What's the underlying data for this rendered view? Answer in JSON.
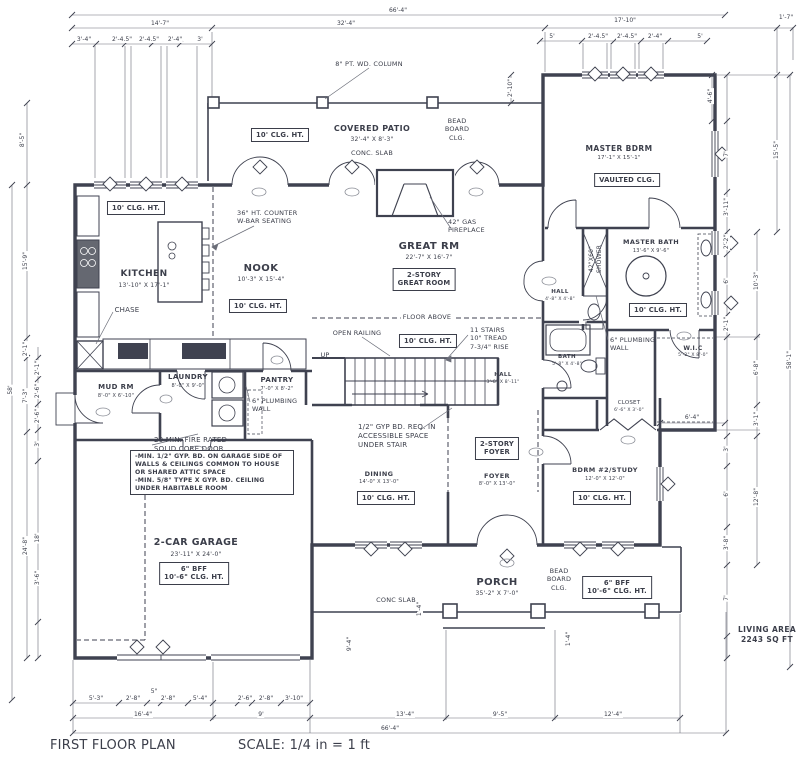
{
  "labels": [
    {
      "id": "title",
      "lines": [
        "FIRST FLOOR PLAN"
      ],
      "x": 50,
      "y": 738,
      "size": 13,
      "align": "l"
    },
    {
      "id": "scale-note",
      "lines": [
        "SCALE: 1/4 in = 1 ft"
      ],
      "x": 238,
      "y": 738,
      "size": 13,
      "align": "l"
    },
    {
      "id": "living-area",
      "lines": [
        "LIVING AREA",
        "2243 SQ FT"
      ],
      "x": 767,
      "y": 625,
      "size": 7.5,
      "bold": true
    },
    {
      "id": "covered-patio",
      "lines": [
        "COVERED PATIO"
      ],
      "x": 372,
      "y": 124,
      "size": 8,
      "bold": true
    },
    {
      "id": "covered-patio-dims",
      "lines": [
        "32'-4\" X 8'-3\""
      ],
      "x": 372,
      "y": 136,
      "size": 6
    },
    {
      "id": "patio-conc-slab",
      "lines": [
        "CONC. SLAB"
      ],
      "x": 372,
      "y": 149,
      "size": 6.5
    },
    {
      "id": "patio-clg-box",
      "lines": [
        "10' CLG. HT."
      ],
      "x": 280,
      "y": 128,
      "box": true
    },
    {
      "id": "column-note",
      "lines": [
        "8\" PT. WD. COLUMN"
      ],
      "x": 369,
      "y": 60,
      "size": 6.5
    },
    {
      "id": "bead-board-clg-top",
      "lines": [
        "BEAD",
        "BOARD",
        "CLG."
      ],
      "x": 457,
      "y": 117,
      "size": 6.5
    },
    {
      "id": "master-bdrm",
      "lines": [
        "MASTER BDRM"
      ],
      "x": 619,
      "y": 144,
      "size": 7.5,
      "bold": true
    },
    {
      "id": "master-bdrm-dims",
      "lines": [
        "17'-1\" X 15'-1\""
      ],
      "x": 619,
      "y": 155,
      "size": 5.5
    },
    {
      "id": "vaulted-clg-box",
      "lines": [
        "VAULTED CLG."
      ],
      "x": 627,
      "y": 173,
      "box": true
    },
    {
      "id": "kitchen",
      "lines": [
        "KITCHEN"
      ],
      "x": 144,
      "y": 269,
      "size": 9,
      "bold": true
    },
    {
      "id": "kitchen-dims",
      "lines": [
        "13'-10\" X 17'-1\""
      ],
      "x": 144,
      "y": 282,
      "size": 6
    },
    {
      "id": "kitchen-clg-box",
      "lines": [
        "10' CLG. HT."
      ],
      "x": 136,
      "y": 201,
      "box": true
    },
    {
      "id": "counter-note",
      "lines": [
        "36\" HT. COUNTER",
        "W-BAR SEATING"
      ],
      "x": 237,
      "y": 209,
      "size": 6.5,
      "align": "l"
    },
    {
      "id": "nook",
      "lines": [
        "NOOK"
      ],
      "x": 261,
      "y": 262,
      "size": 10,
      "bold": true
    },
    {
      "id": "nook-dims",
      "lines": [
        "10'-3\" X 15'-4\""
      ],
      "x": 261,
      "y": 276,
      "size": 6
    },
    {
      "id": "nook-clg-box",
      "lines": [
        "10' CLG. HT."
      ],
      "x": 258,
      "y": 299,
      "box": true
    },
    {
      "id": "chase",
      "lines": [
        "CHASE"
      ],
      "x": 127,
      "y": 306,
      "size": 7
    },
    {
      "id": "great-rm",
      "lines": [
        "GREAT RM"
      ],
      "x": 429,
      "y": 240,
      "size": 10,
      "bold": true
    },
    {
      "id": "great-rm-dims",
      "lines": [
        "22'-7\" X 16'-7\""
      ],
      "x": 429,
      "y": 254,
      "size": 6
    },
    {
      "id": "great-rm-box",
      "lines": [
        "2-STORY",
        "GREAT ROOM"
      ],
      "x": 424,
      "y": 268,
      "box": true
    },
    {
      "id": "fireplace-note",
      "lines": [
        "42\" GAS",
        "FIREPLACE"
      ],
      "x": 448,
      "y": 218,
      "size": 6.5,
      "align": "l"
    },
    {
      "id": "floor-above",
      "lines": [
        "FLOOR ABOVE"
      ],
      "x": 427,
      "y": 313,
      "size": 6.5,
      "bg": true
    },
    {
      "id": "open-railing",
      "lines": [
        "OPEN RAILING"
      ],
      "x": 357,
      "y": 329,
      "size": 6.5
    },
    {
      "id": "stair-clg-box",
      "lines": [
        "10' CLG. HT."
      ],
      "x": 428,
      "y": 334,
      "box": true
    },
    {
      "id": "stairs-note",
      "lines": [
        "11 STAIRS",
        "10\" TREAD",
        "7-3/4\" RISE"
      ],
      "x": 470,
      "y": 326,
      "size": 6.5,
      "align": "l"
    },
    {
      "id": "up-label",
      "lines": [
        "UP"
      ],
      "x": 325,
      "y": 351,
      "size": 6.5
    },
    {
      "id": "master-bath",
      "lines": [
        "MASTER BATH"
      ],
      "x": 651,
      "y": 238,
      "size": 6.5,
      "bold": true
    },
    {
      "id": "master-bath-dims",
      "lines": [
        "13'-6\" X 9'-6\""
      ],
      "x": 651,
      "y": 248,
      "size": 5
    },
    {
      "id": "shower-label",
      "lines": [
        "42\"X60\"",
        "SHOWER"
      ],
      "x": 596,
      "y": 259,
      "size": 6,
      "rot": -90
    },
    {
      "id": "mbath-clg-box",
      "lines": [
        "10' CLG. HT."
      ],
      "x": 658,
      "y": 303,
      "box": true
    },
    {
      "id": "hall-upper",
      "lines": [
        "HALL"
      ],
      "x": 560,
      "y": 289,
      "size": 5.5,
      "bold": true
    },
    {
      "id": "hall-upper-dims",
      "lines": [
        "4'-8\" X 4'-8\""
      ],
      "x": 560,
      "y": 297,
      "size": 4.5
    },
    {
      "id": "plumbing-wall-note-master",
      "lines": [
        "6\" PLUMBING",
        "WALL"
      ],
      "x": 610,
      "y": 336,
      "size": 6.5,
      "align": "l"
    },
    {
      "id": "wic",
      "lines": [
        "W.I.C"
      ],
      "x": 693,
      "y": 345,
      "size": 6,
      "bold": true
    },
    {
      "id": "wic-dims",
      "lines": [
        "5'-2\" X 8'-0\""
      ],
      "x": 693,
      "y": 353,
      "size": 4.5
    },
    {
      "id": "bath",
      "lines": [
        "BATH"
      ],
      "x": 567,
      "y": 354,
      "size": 5.5,
      "bold": true
    },
    {
      "id": "bath-dims",
      "lines": [
        "5'-8\" X 4'-8\""
      ],
      "x": 567,
      "y": 362,
      "size": 4.5
    },
    {
      "id": "closet",
      "lines": [
        "CLOSET"
      ],
      "x": 629,
      "y": 400,
      "size": 5.5
    },
    {
      "id": "closet-dims",
      "lines": [
        "6'-6\" X 3'-0\""
      ],
      "x": 629,
      "y": 408,
      "size": 4.5
    },
    {
      "id": "mud-rm",
      "lines": [
        "MUD RM"
      ],
      "x": 116,
      "y": 383,
      "size": 7,
      "bold": true
    },
    {
      "id": "mud-rm-dims",
      "lines": [
        "8'-0\" X 6'-10\""
      ],
      "x": 116,
      "y": 393,
      "size": 5
    },
    {
      "id": "laundry",
      "lines": [
        "LAUNDRY"
      ],
      "x": 188,
      "y": 373,
      "size": 7,
      "bold": true
    },
    {
      "id": "laundry-dims",
      "lines": [
        "8'-0\" X 9'-0\""
      ],
      "x": 188,
      "y": 383,
      "size": 5
    },
    {
      "id": "pantry",
      "lines": [
        "PANTRY"
      ],
      "x": 277,
      "y": 376,
      "size": 7,
      "bold": true
    },
    {
      "id": "pantry-dims",
      "lines": [
        "7'-0\" X 8'-2\""
      ],
      "x": 277,
      "y": 386,
      "size": 5
    },
    {
      "id": "plumbing-wall-note-pantry",
      "lines": [
        "6\" PLUMBING",
        "WALL"
      ],
      "x": 252,
      "y": 397,
      "size": 6.5,
      "align": "l"
    },
    {
      "id": "fire-door-note",
      "lines": [
        "20 MIN. FIRE RATED",
        "SOLID CORE DOOR"
      ],
      "x": 154,
      "y": 436,
      "size": 7,
      "align": "l"
    },
    {
      "id": "garage-gyp-note",
      "lines": [
        "-MIN. 1/2\" GYP. BD. ON GARAGE SIDE OF",
        "WALLS & CEILINGS COMMON TO HOUSE",
        "OR SHARED ATTIC SPACE",
        "-MIN. 5/8\" TYPE X GYP. BD. CEILING",
        "UNDER HABITABLE ROOM"
      ],
      "x": 130,
      "y": 450,
      "size": 6.2,
      "align": "l",
      "box": true,
      "w": 154
    },
    {
      "id": "garage",
      "lines": [
        "2-CAR GARAGE"
      ],
      "x": 196,
      "y": 537,
      "size": 9.5,
      "bold": true
    },
    {
      "id": "garage-dims",
      "lines": [
        "23'-11\" X 24'-0\""
      ],
      "x": 196,
      "y": 551,
      "size": 6
    },
    {
      "id": "garage-bff-box",
      "lines": [
        "6\" BFF",
        "10'-6\" CLG. HT."
      ],
      "x": 194,
      "y": 562,
      "box": true
    },
    {
      "id": "understair-note",
      "lines": [
        "1/2\" GYP BD. REQ. IN",
        "ACCESSIBLE SPACE",
        "UNDER STAIR"
      ],
      "x": 358,
      "y": 423,
      "size": 7,
      "align": "l"
    },
    {
      "id": "dining",
      "lines": [
        "DINING"
      ],
      "x": 379,
      "y": 470,
      "size": 6.5,
      "bold": true
    },
    {
      "id": "dining-dims",
      "lines": [
        "14'-0\" X 13'-0\""
      ],
      "x": 379,
      "y": 479,
      "size": 5
    },
    {
      "id": "dining-clg-box",
      "lines": [
        "10' CLG. HT."
      ],
      "x": 386,
      "y": 491,
      "box": true
    },
    {
      "id": "foyer-box",
      "lines": [
        "2-STORY",
        "FOYER"
      ],
      "x": 497,
      "y": 437,
      "box": true
    },
    {
      "id": "foyer",
      "lines": [
        "FOYER"
      ],
      "x": 497,
      "y": 472,
      "size": 6.5,
      "bold": true
    },
    {
      "id": "foyer-dims",
      "lines": [
        "8'-0\" X 13'-0\""
      ],
      "x": 497,
      "y": 481,
      "size": 5
    },
    {
      "id": "hall-lower",
      "lines": [
        "HALL"
      ],
      "x": 503,
      "y": 372,
      "size": 5.5,
      "bold": true
    },
    {
      "id": "hall-lower-dims",
      "lines": [
        "3'-8\" X 8'-11\""
      ],
      "x": 503,
      "y": 380,
      "size": 4.5
    },
    {
      "id": "bdrm2",
      "lines": [
        "BDRM #2/STUDY"
      ],
      "x": 605,
      "y": 466,
      "size": 6.5,
      "bold": true
    },
    {
      "id": "bdrm2-dims",
      "lines": [
        "12'-0\" X 12'-0\""
      ],
      "x": 605,
      "y": 476,
      "size": 5
    },
    {
      "id": "bdrm2-clg-box",
      "lines": [
        "10' CLG. HT."
      ],
      "x": 602,
      "y": 491,
      "box": true
    },
    {
      "id": "porch",
      "lines": [
        "PORCH"
      ],
      "x": 497,
      "y": 576,
      "size": 10,
      "bold": true
    },
    {
      "id": "porch-dims",
      "lines": [
        "35'-2\" X 7'-0\""
      ],
      "x": 497,
      "y": 590,
      "size": 6
    },
    {
      "id": "porch-conc-slab",
      "lines": [
        "CONC SLAB"
      ],
      "x": 396,
      "y": 596,
      "size": 6.5
    },
    {
      "id": "bead-board-clg-porch",
      "lines": [
        "BEAD",
        "BOARD",
        "CLG."
      ],
      "x": 559,
      "y": 567,
      "size": 6.5
    },
    {
      "id": "porch-bff-box",
      "lines": [
        "6\" BFF",
        "10'-6\" CLG. HT."
      ],
      "x": 617,
      "y": 576,
      "box": true
    }
  ],
  "dims": [
    {
      "t": "66'-4\"",
      "x": 398,
      "y": 11
    },
    {
      "t": "14'-7\"",
      "x": 160,
      "y": 24
    },
    {
      "t": "32'-4\"",
      "x": 346,
      "y": 24
    },
    {
      "t": "17'-10\"",
      "x": 625,
      "y": 21
    },
    {
      "t": "1'-7\"",
      "x": 786,
      "y": 18
    },
    {
      "t": "3'-4\"",
      "x": 84,
      "y": 40
    },
    {
      "t": "2'-4.5\"",
      "x": 122,
      "y": 40
    },
    {
      "t": "2'-4.5\"",
      "x": 149,
      "y": 40
    },
    {
      "t": "2'-4\"",
      "x": 175,
      "y": 40
    },
    {
      "t": "3'",
      "x": 200,
      "y": 40
    },
    {
      "t": "5'",
      "x": 552,
      "y": 37
    },
    {
      "t": "2'-4.5\"",
      "x": 598,
      "y": 37
    },
    {
      "t": "2'-4.5\"",
      "x": 627,
      "y": 37
    },
    {
      "t": "2'-4\"",
      "x": 655,
      "y": 37
    },
    {
      "t": "5'",
      "x": 700,
      "y": 37
    },
    {
      "t": "2'-10\"",
      "x": 511,
      "y": 88,
      "r": -90
    },
    {
      "t": "8'-5\"",
      "x": 23,
      "y": 140,
      "r": -90
    },
    {
      "t": "15'-9\"",
      "x": 26,
      "y": 261,
      "r": -90
    },
    {
      "t": "2'-1\"",
      "x": 26,
      "y": 349,
      "r": -90
    },
    {
      "t": "7'-3\"",
      "x": 26,
      "y": 396,
      "r": -90
    },
    {
      "t": "24'-8\"",
      "x": 26,
      "y": 546,
      "r": -90
    },
    {
      "t": "58'",
      "x": 11,
      "y": 390,
      "r": -90
    },
    {
      "t": "2'-1\"",
      "x": 38,
      "y": 368,
      "r": -90
    },
    {
      "t": "2'-6\"",
      "x": 38,
      "y": 391,
      "r": -90
    },
    {
      "t": "2'-6\"",
      "x": 38,
      "y": 416,
      "r": -90
    },
    {
      "t": "3'",
      "x": 38,
      "y": 444,
      "r": -90
    },
    {
      "t": "18'",
      "x": 38,
      "y": 538,
      "r": -90
    },
    {
      "t": "3'-6\"",
      "x": 38,
      "y": 578,
      "r": -90
    },
    {
      "t": "4'-6\"",
      "x": 711,
      "y": 96,
      "r": -90
    },
    {
      "t": "7'",
      "x": 727,
      "y": 154,
      "r": -90
    },
    {
      "t": "3'-11\"",
      "x": 727,
      "y": 207,
      "r": -90
    },
    {
      "t": "2'-2\"",
      "x": 727,
      "y": 242,
      "r": -90
    },
    {
      "t": "6'",
      "x": 727,
      "y": 281,
      "r": -90
    },
    {
      "t": "2'-1\"",
      "x": 727,
      "y": 324,
      "r": -90
    },
    {
      "t": "10'-3\"",
      "x": 757,
      "y": 281,
      "r": -90
    },
    {
      "t": "6'-8\"",
      "x": 757,
      "y": 368,
      "r": -90
    },
    {
      "t": "3'-1\"",
      "x": 757,
      "y": 419,
      "r": -90
    },
    {
      "t": "3'",
      "x": 727,
      "y": 449,
      "r": -90
    },
    {
      "t": "6'",
      "x": 727,
      "y": 494,
      "r": -90
    },
    {
      "t": "3'-8\"",
      "x": 727,
      "y": 543,
      "r": -90
    },
    {
      "t": "12'-8\"",
      "x": 757,
      "y": 497,
      "r": -90
    },
    {
      "t": "7'",
      "x": 727,
      "y": 598,
      "r": -90
    },
    {
      "t": "15'-5\"",
      "x": 777,
      "y": 150,
      "r": -90
    },
    {
      "t": "58'-1\"",
      "x": 790,
      "y": 360,
      "r": -90
    },
    {
      "t": "6'-4\"",
      "x": 692,
      "y": 418
    },
    {
      "t": "9'-4\"",
      "x": 350,
      "y": 644,
      "r": -90
    },
    {
      "t": "1'-4\"",
      "x": 420,
      "y": 609,
      "r": -90
    },
    {
      "t": "1'-4\"",
      "x": 569,
      "y": 639,
      "r": -90
    },
    {
      "t": "5'-3\"",
      "x": 96,
      "y": 699
    },
    {
      "t": "2'-8\"",
      "x": 133,
      "y": 699
    },
    {
      "t": "5\"",
      "x": 154,
      "y": 692
    },
    {
      "t": "2'-8\"",
      "x": 168,
      "y": 699
    },
    {
      "t": "5'-4\"",
      "x": 200,
      "y": 699
    },
    {
      "t": "2'-6\"",
      "x": 245,
      "y": 699
    },
    {
      "t": "2'-8\"",
      "x": 266,
      "y": 699
    },
    {
      "t": "3'-10\"",
      "x": 294,
      "y": 699
    },
    {
      "t": "16'-4\"",
      "x": 143,
      "y": 715
    },
    {
      "t": "9'",
      "x": 261,
      "y": 715
    },
    {
      "t": "13'-4\"",
      "x": 405,
      "y": 715
    },
    {
      "t": "9'-5\"",
      "x": 500,
      "y": 715
    },
    {
      "t": "12'-4\"",
      "x": 613,
      "y": 715
    },
    {
      "t": "66'-4\"",
      "x": 390,
      "y": 729
    }
  ]
}
